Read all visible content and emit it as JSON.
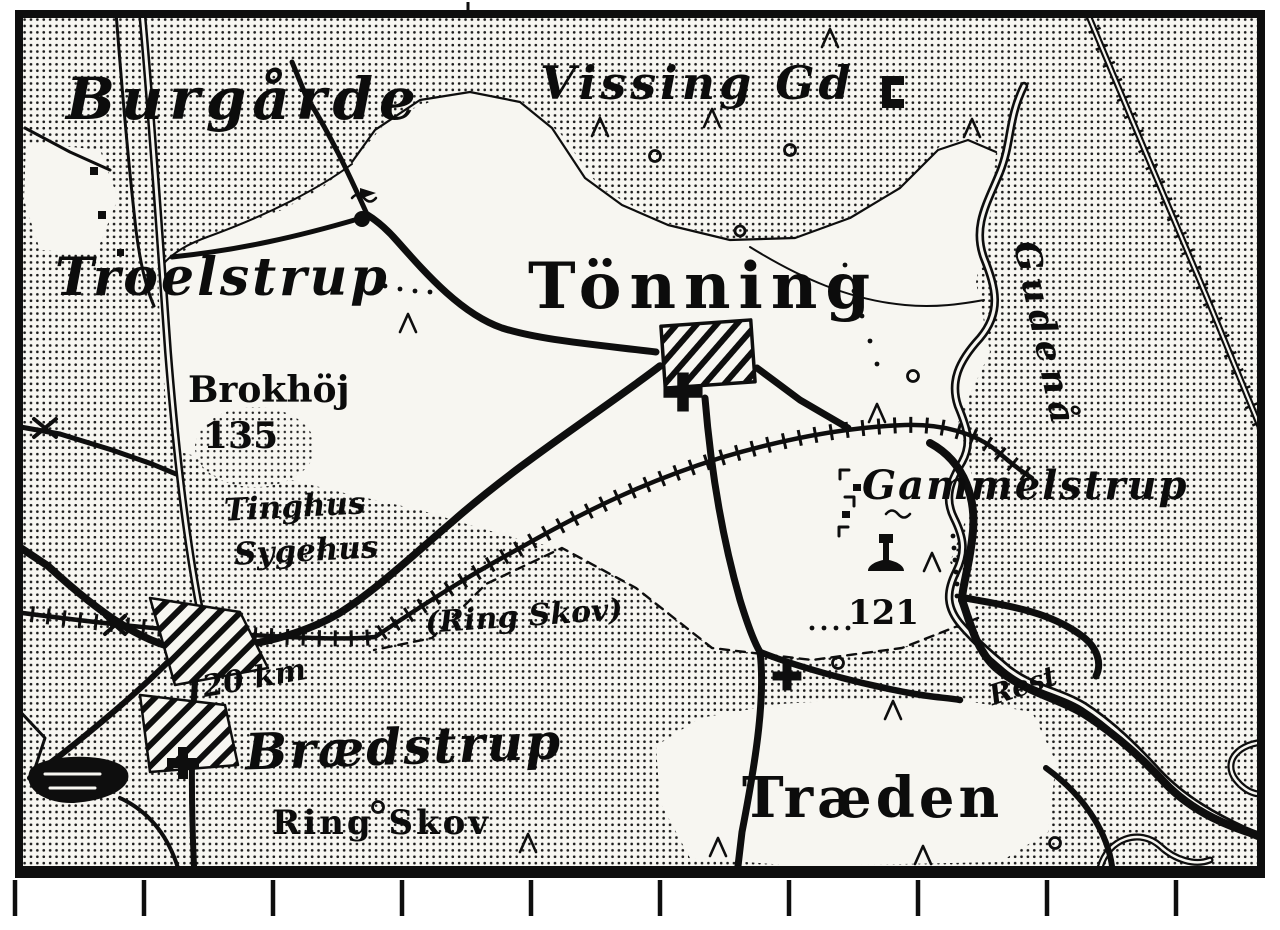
{
  "map": {
    "title": "Historic Danish topographic map extract (Tönning / Brædstrup area)",
    "labels": {
      "burgarde": "Burgårde",
      "vissing_gd": "Vissing Gd",
      "troelstrup": "Troelstrup",
      "tonning": "Tönning",
      "brokhoj": "Brokhöj",
      "brokhoj_elevation": "135",
      "tinghus": "Tinghus",
      "sygehus": "Sygehus",
      "gammelstrup": "Gammelstrup",
      "gudenaa": "Gudenå",
      "ring_skov_paren": "(Ring Skov)",
      "elevation_121": "121",
      "distance_20km": "20 km",
      "braedstrup": "Brædstrup",
      "ring_skov": "Ring Skov",
      "traeden": "Træden",
      "rest": "Rest"
    },
    "colors": {
      "ink": "#0e0e0e",
      "paper": "#f7f6f1"
    }
  }
}
